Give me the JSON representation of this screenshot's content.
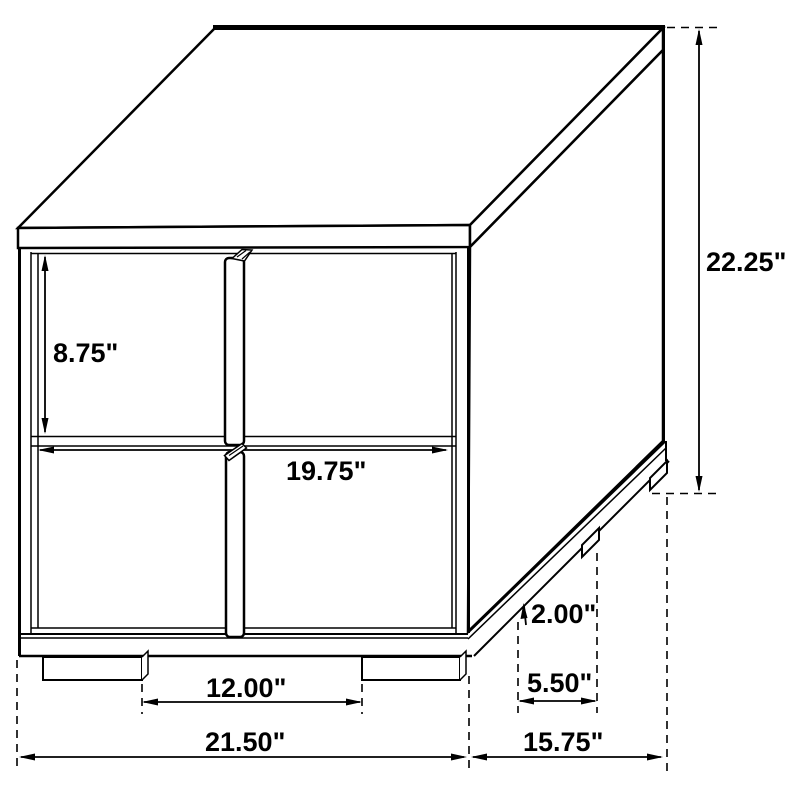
{
  "page": {
    "background": "#ffffff",
    "description": "Technical dimension line drawing of a two-drawer nightstand shown in perspective"
  },
  "diagram": {
    "type": "furniture-dimension-drawing",
    "subject": "nightstand-with-two-drawers",
    "units": "inches",
    "colors": {
      "line": "#000000",
      "text": "#000000",
      "background": "#ffffff"
    },
    "dimensions": {
      "overall_height": {
        "label": "22.25\"",
        "value": 22.25
      },
      "upper_drawer_height": {
        "label": "8.75\"",
        "value": 8.75
      },
      "drawer_front_width": {
        "label": "19.75\"",
        "value": 19.75
      },
      "base_height": {
        "label": "2.00\"",
        "value": 2.0
      },
      "side_leg_spacing": {
        "label": "5.50\"",
        "value": 5.5
      },
      "front_leg_spacing": {
        "label": "12.00\"",
        "value": 12.0
      },
      "overall_width": {
        "label": "21.50\"",
        "value": 21.5
      },
      "overall_depth": {
        "label": "15.75\"",
        "value": 15.75
      }
    }
  }
}
